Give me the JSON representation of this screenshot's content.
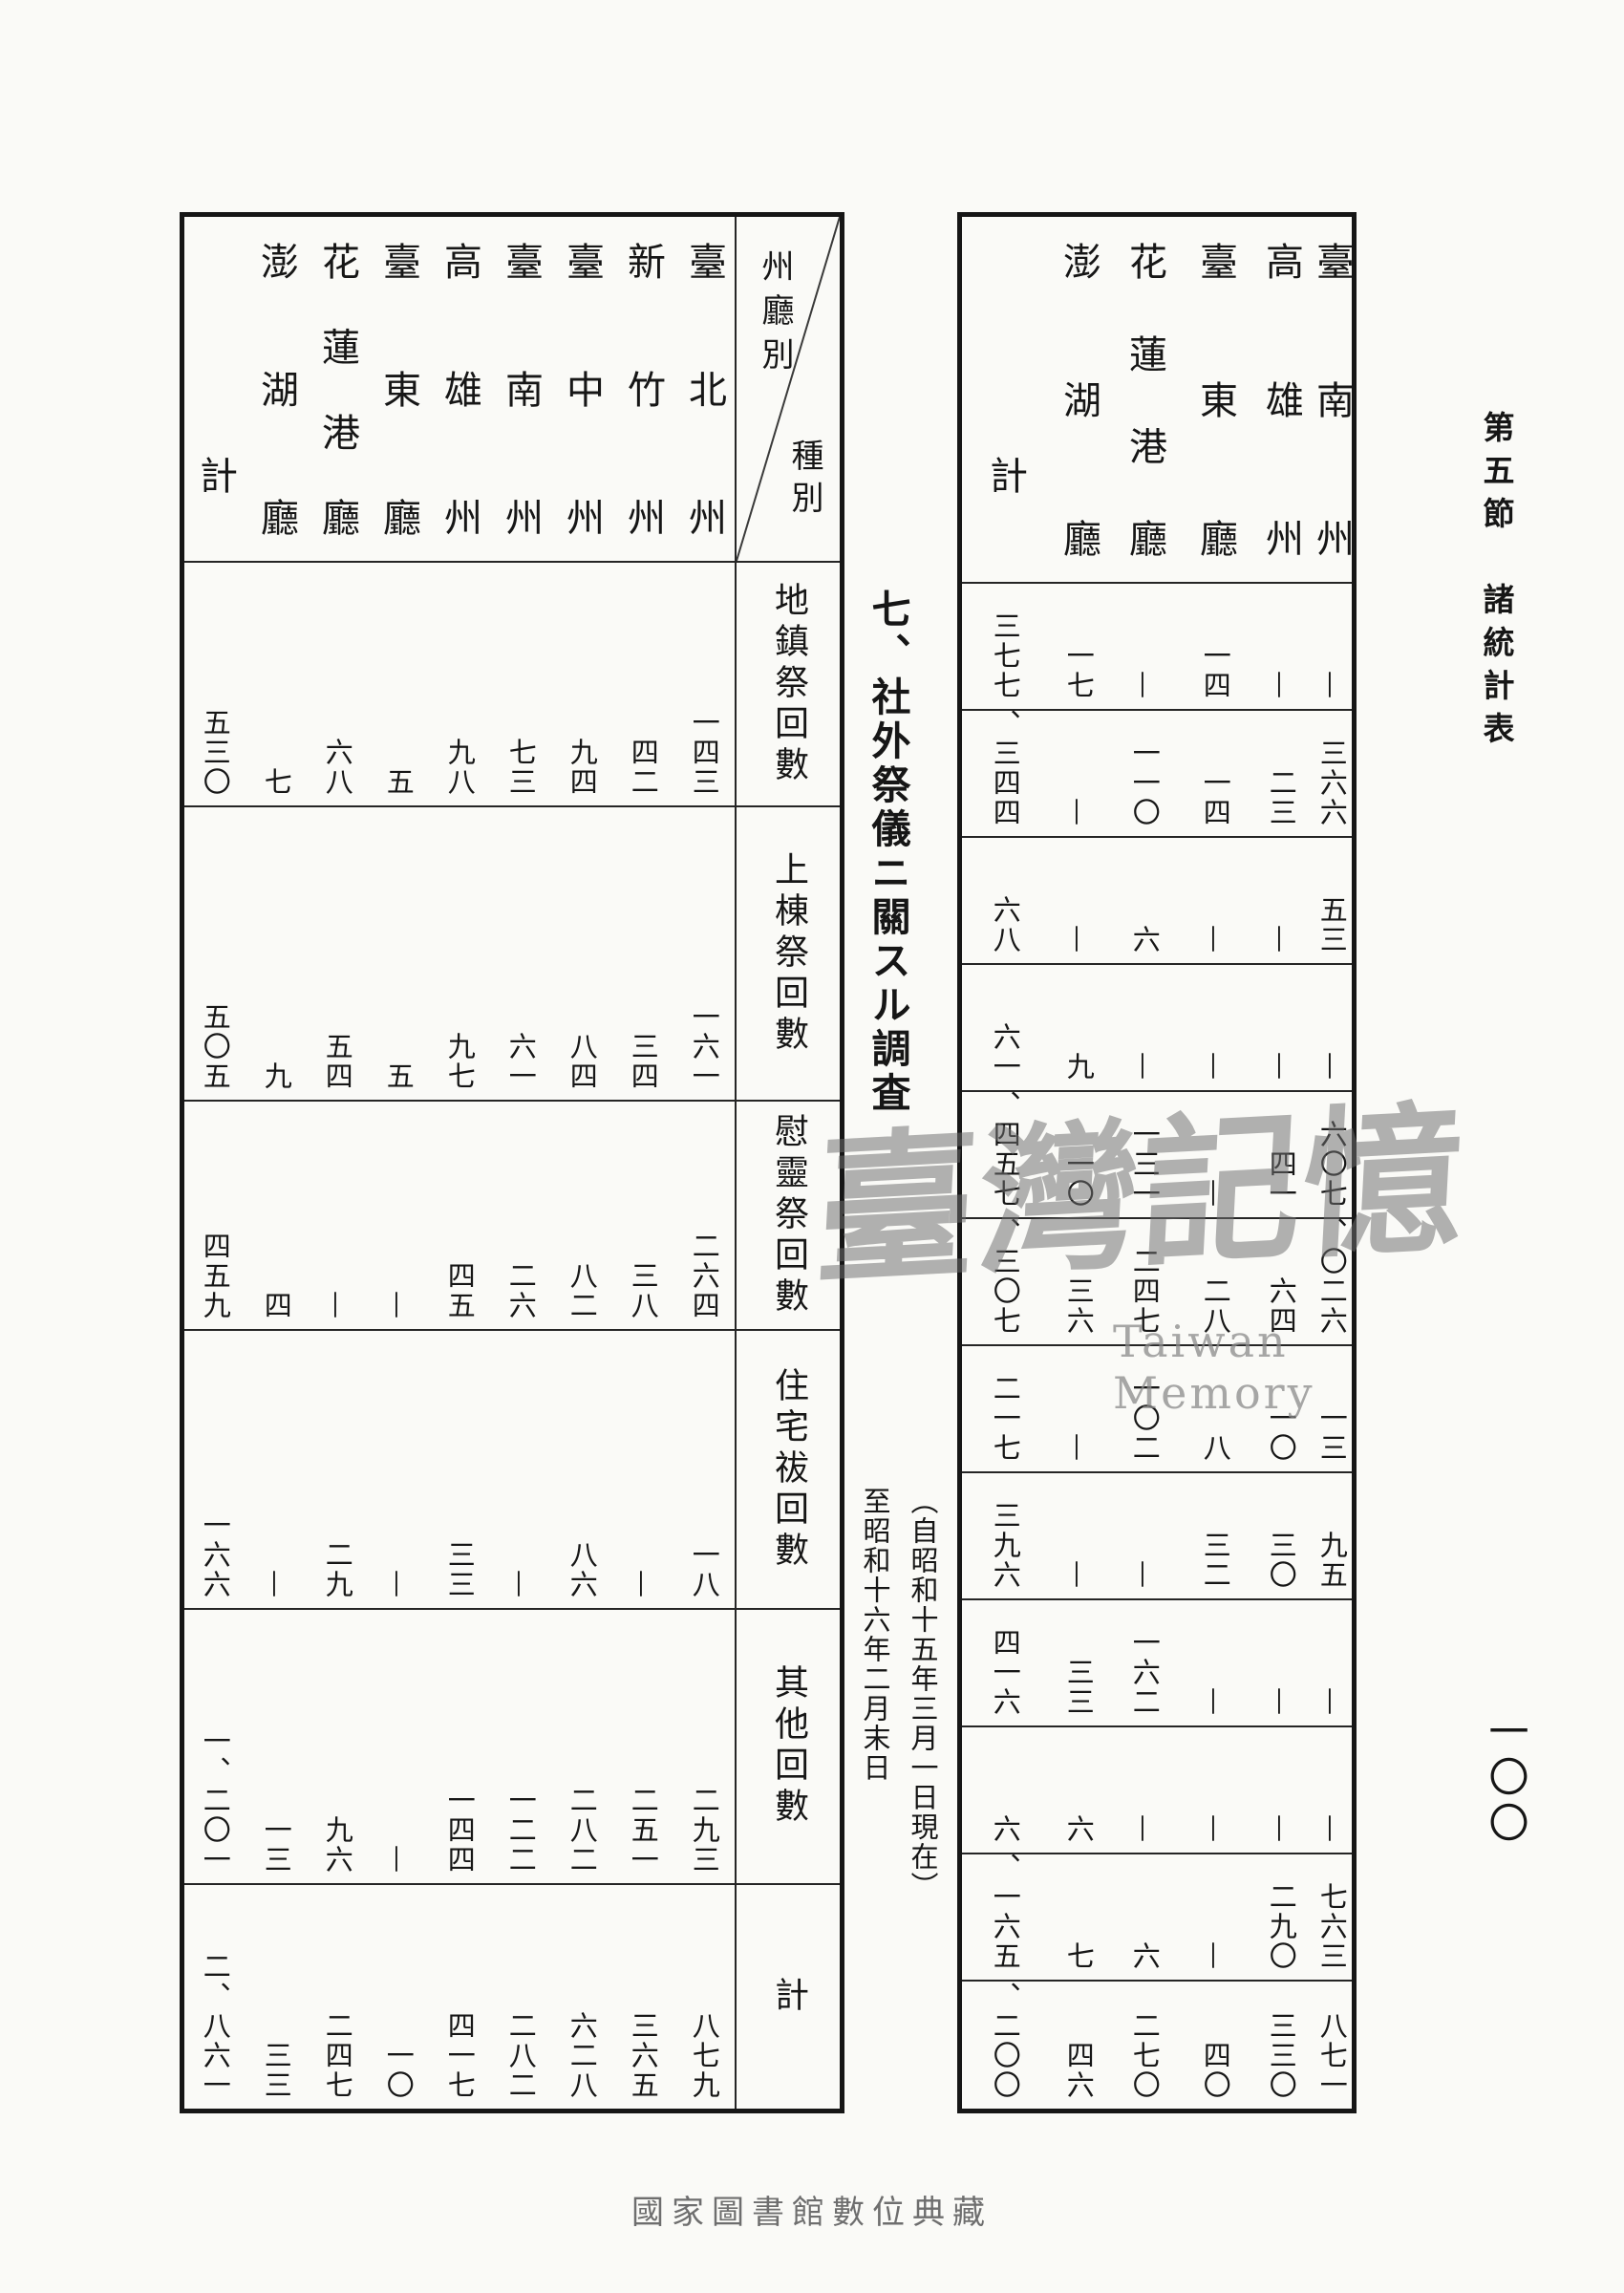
{
  "page": {
    "section_title": "第五節　諸統計表",
    "page_number": "一〇〇",
    "bottom_caption": "國家圖書館數位典藏",
    "watermark": {
      "cjk": "臺灣記憶",
      "latin": "Taiwan Memory"
    }
  },
  "main": {
    "title": "七、社外祭儀ニ關スル調査",
    "note": "（自昭和十五年三月一日現在）\n至昭和十六年二月末日"
  },
  "left_table": {
    "corner": {
      "row_axis": "州廳別",
      "col_axis": "種別"
    },
    "columns": [
      "臺北州",
      "新竹州",
      "臺中州",
      "臺南州",
      "高雄州",
      "臺東廳",
      "花蓮港廳",
      "澎湖廳",
      "計"
    ],
    "rows": [
      {
        "label": "地鎮祭回數",
        "values": [
          "一四三",
          "四二",
          "九四",
          "七三",
          "九八",
          "五",
          "六八",
          "七",
          "五三〇"
        ]
      },
      {
        "label": "上棟祭回數",
        "values": [
          "一六一",
          "三四",
          "八四",
          "六一",
          "九七",
          "五",
          "五四",
          "九",
          "五〇五"
        ]
      },
      {
        "label": "慰靈祭回數",
        "values": [
          "二六四",
          "三八",
          "八二",
          "二六",
          "四五",
          "—",
          "—",
          "四",
          "四五九"
        ]
      },
      {
        "label": "住宅祓回數",
        "values": [
          "一八",
          "—",
          "八六",
          "—",
          "三三",
          "—",
          "二九",
          "—",
          "一六六"
        ]
      },
      {
        "label": "其他回數",
        "values": [
          "二九三",
          "二五一",
          "二八二",
          "一二二",
          "一四四",
          "—",
          "九六",
          "一三",
          "一、二〇一"
        ]
      },
      {
        "label": "計",
        "values": [
          "八七九",
          "三六五",
          "六二八",
          "二八二",
          "四一七",
          "一〇",
          "二四七",
          "三三",
          "二、八六一"
        ]
      }
    ]
  },
  "right_table": {
    "columns": [
      "臺南州",
      "高雄州",
      "臺東廳",
      "花蓮港廳",
      "澎湖廳",
      "計"
    ],
    "rows": [
      {
        "values": [
          "—",
          "—",
          "一四",
          "—",
          "一七",
          "三七七"
        ]
      },
      {
        "values": [
          "三六六",
          "二三",
          "一四",
          "一一〇",
          "—",
          "一、三四四"
        ]
      },
      {
        "values": [
          "五三",
          "—",
          "—",
          "六",
          "—",
          "六八"
        ]
      },
      {
        "values": [
          "—",
          "—",
          "—",
          "—",
          "九",
          "六一"
        ]
      },
      {
        "values": [
          "六〇七",
          "四一",
          "—",
          "一三一",
          "一〇",
          "一、四五七"
        ]
      },
      {
        "values": [
          "一、〇二六",
          "六四",
          "二八",
          "二四七",
          "三六",
          "三、三〇七"
        ]
      },
      {
        "values": [
          "一三",
          "一〇",
          "八",
          "一〇二",
          "—",
          "二一七"
        ]
      },
      {
        "values": [
          "九五",
          "三〇",
          "三二",
          "—",
          "—",
          "三九六"
        ]
      },
      {
        "values": [
          "—",
          "—",
          "—",
          "一六二",
          "三三",
          "四一六"
        ]
      },
      {
        "values": [
          "—",
          "—",
          "—",
          "—",
          "六",
          "六"
        ]
      },
      {
        "values": [
          "七六三",
          "二九〇",
          "—",
          "六",
          "七",
          "三、一六五"
        ]
      },
      {
        "values": [
          "八七一",
          "三三〇",
          "四〇",
          "二七〇",
          "四六",
          "四、二〇〇"
        ]
      }
    ]
  }
}
